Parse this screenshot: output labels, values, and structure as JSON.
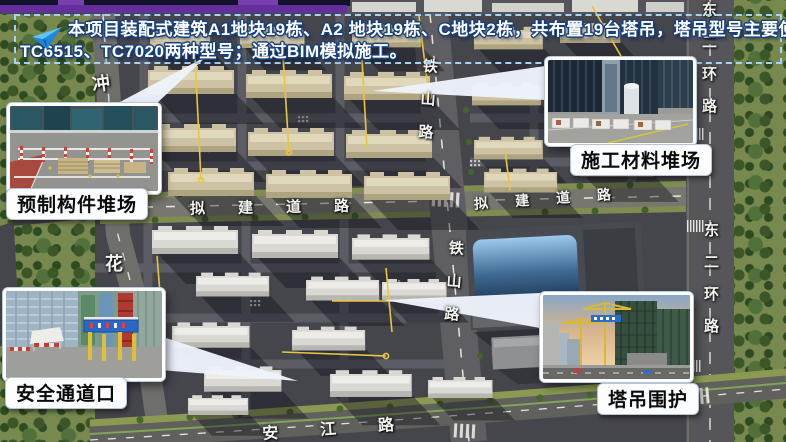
{
  "slide": {
    "top_bar_color": "#63309b"
  },
  "banner": {
    "icon": "paper-plane-icon",
    "line1": "本项目装配式建筑A1地块19栋、A2 地块19栋、C地块2栋，共布置19台塔吊，塔吊型号主要使用",
    "line2": "TC6515、TC7020两种型号；通过BIM模拟施工。",
    "border_color": "#a5d4f2",
    "text_color": "#ffffff",
    "outline_color": "#17407e"
  },
  "callouts": {
    "precast": {
      "label": "预制构件堆场"
    },
    "material": {
      "label": "施工材料堆场"
    },
    "safety": {
      "label": "安全通道口"
    },
    "crane": {
      "label": "塔吊围护"
    }
  },
  "roads": {
    "tieshan": "铁山路",
    "nijian": "拟建道路",
    "dongerhuan": "东二环路",
    "anjiang": "安江路",
    "hua": "花",
    "chong": "冲"
  },
  "map": {
    "crane_line_color": "#e9c63f",
    "road_label_color": "#f2f2ee",
    "callout_pointer_color": "#edf3fb"
  }
}
